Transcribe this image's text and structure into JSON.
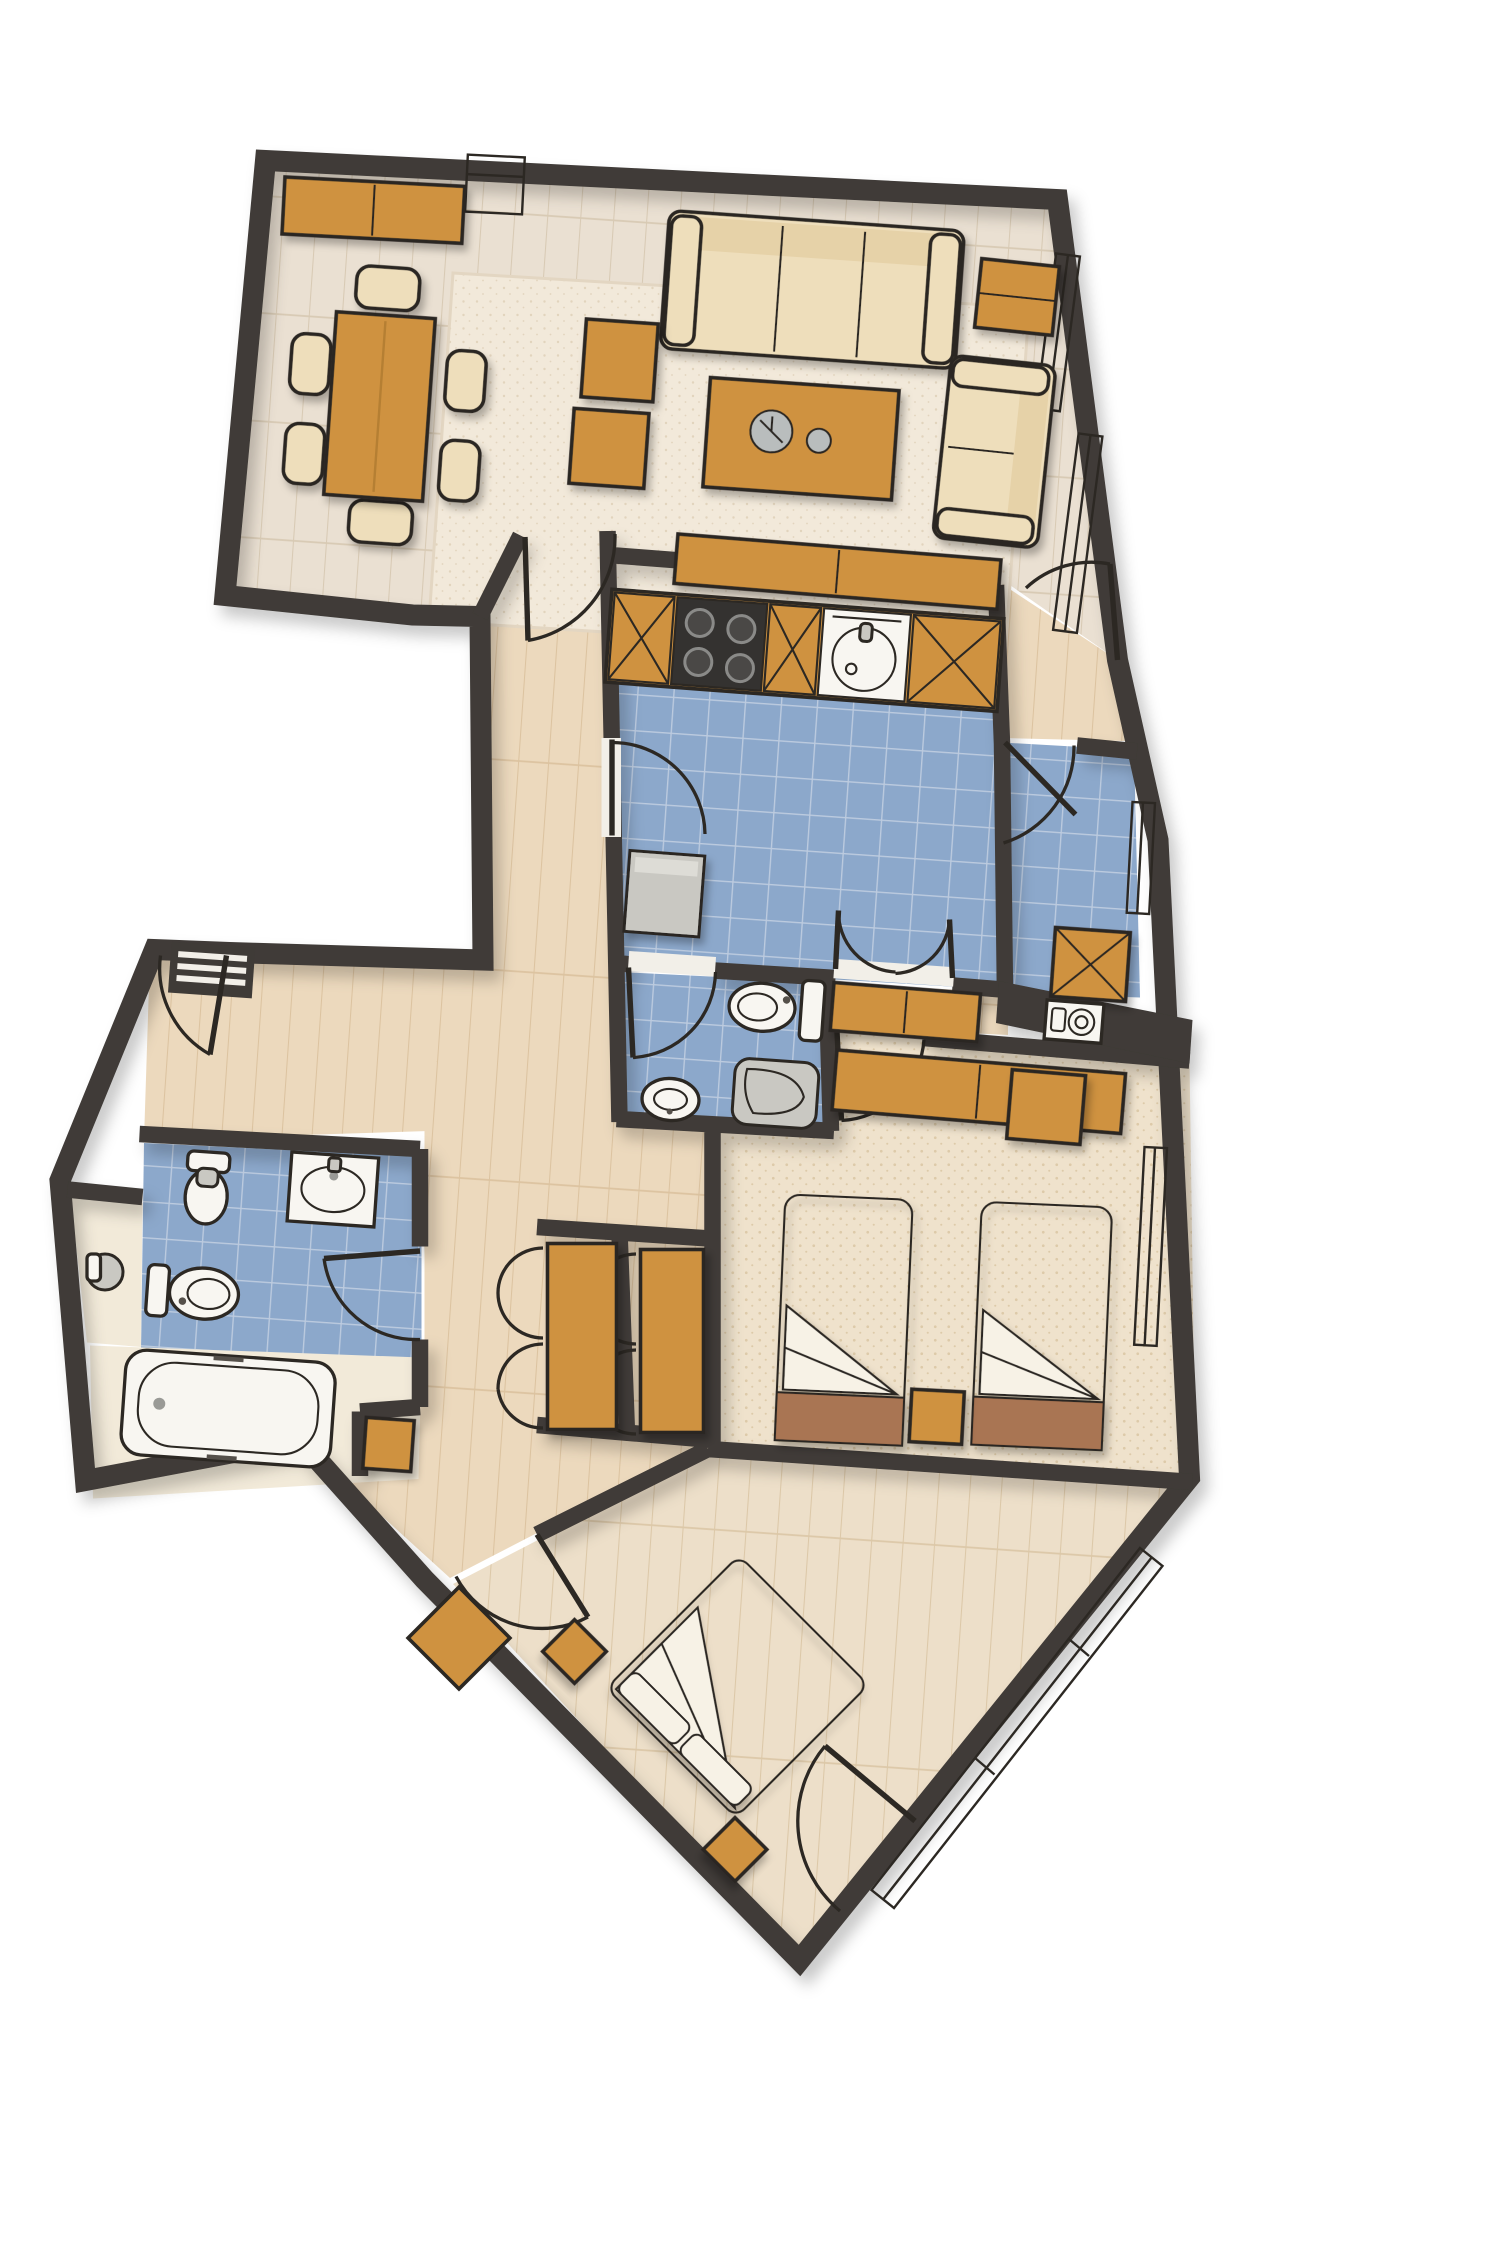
{
  "title": "Apartment floor plan — hand-drawn architectural top view",
  "colors": {
    "wall": "#3f3b37",
    "outline": "#2c2823",
    "wood_floor": "#eae0d2",
    "wood_floor_line": "#d8cab4",
    "hall_floor": "#ecd9bd",
    "hall_floor_line": "#dcc3a0",
    "master_floor": "#eddfc9",
    "master_floor_line": "#dcc8a8",
    "tile": "#8ca8cb",
    "tile_line": "#bccbdf",
    "carpet": "#efe2cc",
    "carpet_dot": "#ddcaa9",
    "rug": "#f2e9da",
    "rug_dot": "#e2d4bd",
    "wood": "#cf9240",
    "wood_light": "#dda655",
    "wood_dark": "#9a6526",
    "upholstery": "#eedebb",
    "fixture": "#f8f6f1",
    "fixture_gray": "#c9c8c2",
    "steel": "#b9bdbd",
    "stove": "#343230",
    "mattress": "#e7cb9e",
    "mattress_dot": "#d5b47c",
    "bed_footer": "#a97553",
    "sheet": "#f7f2e6",
    "void": "#ffffff"
  },
  "rooms": [
    {
      "id": "living-dining",
      "label": "Living / dining room",
      "floor": "light wood planks",
      "furniture": [
        "wall sideboard",
        "dining table",
        "six dining chairs",
        "two ottoman poufs",
        "three-seat sofa",
        "corner side table",
        "two-seat loveseat",
        "coffee table with decor",
        "area rug",
        "media console"
      ]
    },
    {
      "id": "kitchen",
      "label": "Kitchen",
      "floor": "blue tile",
      "furniture": [
        "base cabinet",
        "four-burner stove",
        "base cabinet",
        "round sink unit",
        "base cabinet",
        "gray appliance"
      ]
    },
    {
      "id": "guest-wc",
      "label": "Guest WC",
      "floor": "blue tile",
      "furniture": [
        "toilet",
        "oval washbasin",
        "shower tray"
      ]
    },
    {
      "id": "utility",
      "label": "Utility room",
      "floor": "blue tile",
      "furniture": [
        "storage cabinet",
        "washing machine"
      ]
    },
    {
      "id": "bathroom",
      "label": "Bathroom",
      "floor": "blue tile + cream",
      "furniture": [
        "bidet",
        "counter washbasin",
        "toilet",
        "bathtub",
        "wood cabinet",
        "water heater niche"
      ]
    },
    {
      "id": "hallway",
      "label": "Hallway and entry",
      "floor": "warm wood planks",
      "furniture": [
        "vent grate",
        "two bi-fold wardrobes",
        "hall console"
      ]
    },
    {
      "id": "twin-bedroom",
      "label": "Twin bedroom",
      "floor": "speckled carpet",
      "furniture": [
        "long desk",
        "side desk",
        "single bed",
        "single bed",
        "nightstand"
      ]
    },
    {
      "id": "master-bedroom",
      "label": "Master bedroom",
      "floor": "wood planks",
      "furniture": [
        "double bed placed diagonally",
        "two diagonal nightstands",
        "entry wood mat"
      ]
    }
  ],
  "openings": {
    "doors": 11,
    "door_swing_arcs": "quarter-circle arcs",
    "double_swing_doors": 1,
    "bifold_wardrobe_doors": 2,
    "windows": 6
  }
}
